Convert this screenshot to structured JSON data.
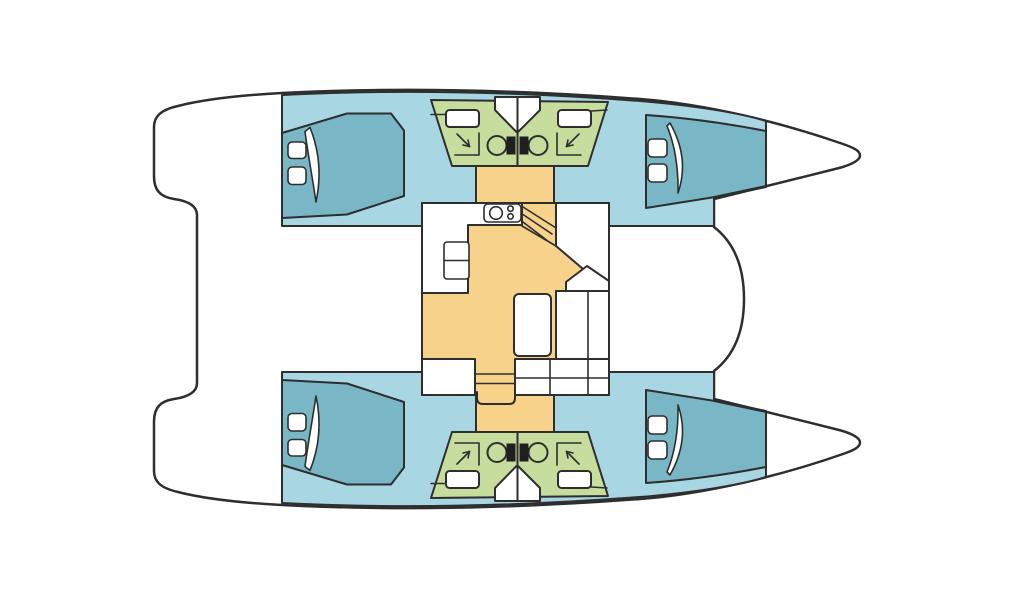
{
  "diagram": {
    "type": "floorplan",
    "subject": "sailing catamaran interior layout",
    "view": "top-down",
    "bow_direction": "right",
    "colors": {
      "background": "#ffffff",
      "outline": "#2e2e2e",
      "deck": "#ffffff",
      "hull": "#a9d6e3",
      "berth": "#79b7c7",
      "head": "#c6dd9e",
      "saloon_floor": "#f6d28b",
      "fixture": "#ffffff",
      "toilet_tank": "#1f1f1f"
    },
    "legend": [
      {
        "id": "hull-interior",
        "label": "hull interior walkway",
        "color_key": "hull"
      },
      {
        "id": "berth",
        "label": "double berth with pillows",
        "color_key": "berth"
      },
      {
        "id": "head",
        "label": "bathroom (head) with sink, toilet, shower",
        "color_key": "head"
      },
      {
        "id": "saloon",
        "label": "saloon and galley floor",
        "color_key": "saloon_floor"
      },
      {
        "id": "deck",
        "label": "deck, cockpit and bow area",
        "color_key": "deck"
      }
    ],
    "layout": {
      "hulls": [
        {
          "id": "port-hull",
          "position": "top",
          "cabins": [
            {
              "id": "port-aft-cabin",
              "berth": "double",
              "pillows": 2,
              "door_swing": 1
            },
            {
              "id": "port-forward-cabin",
              "berth": "double",
              "pillows": 2,
              "door_swing": 1
            }
          ],
          "heads": [
            {
              "id": "port-aft-head",
              "sink": 1,
              "toilet": 1,
              "shower": 1
            },
            {
              "id": "port-forward-head",
              "sink": 1,
              "toilet": 1,
              "shower": 1
            }
          ]
        },
        {
          "id": "starboard-hull",
          "position": "bottom",
          "cabins": [
            {
              "id": "starboard-aft-cabin",
              "berth": "double",
              "pillows": 2,
              "door_swing": 1
            },
            {
              "id": "starboard-forward-cabin",
              "berth": "double",
              "pillows": 2,
              "door_swing": 1
            }
          ],
          "heads": [
            {
              "id": "starboard-aft-head",
              "sink": 1,
              "toilet": 1,
              "shower": 1
            },
            {
              "id": "starboard-forward-head",
              "sink": 1,
              "toilet": 1,
              "shower": 1
            }
          ]
        }
      ],
      "saloon": {
        "galley": {
          "counter": "L-shaped",
          "stove_burners": 3,
          "cabinet_doors": 2
        },
        "dinette": {
          "table": 1,
          "settee": "L-shaped",
          "cushion_sections": 5
        },
        "nav_seat": 1,
        "companionway_steps": 3,
        "hull_staircases": 2
      },
      "totals": {
        "cabins": 4,
        "heads": 4,
        "berths": 4
      }
    }
  }
}
